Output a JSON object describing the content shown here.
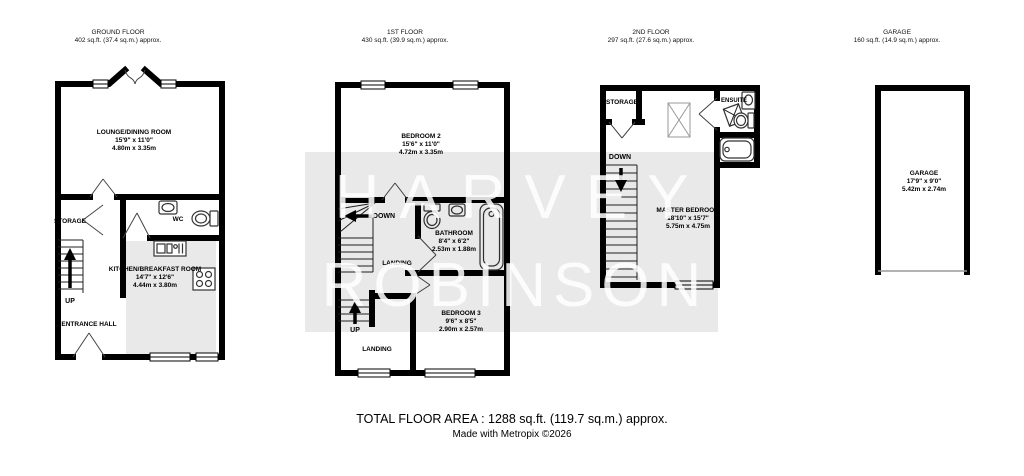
{
  "watermark": {
    "line1": "HARVEY",
    "line2": "ROBINSON"
  },
  "footer": {
    "total_area": "TOTAL FLOOR AREA : 1288 sq.ft. (119.7 sq.m.) approx.",
    "credit": "Made with Metropix ©2026"
  },
  "floors": {
    "ground": {
      "title": "GROUND FLOOR",
      "area": "402 sq.ft. (37.4 sq.m.) approx.",
      "rooms": {
        "lounge": {
          "name": "LOUNGE/DINING ROOM",
          "imperial": "15'9\" x 11'0\"",
          "metric": "4.80m x 3.35m"
        },
        "kitchen": {
          "name": "KITCHEN/BREAKFAST ROOM",
          "imperial": "14'7\" x 12'6\"",
          "metric": "4.44m x 3.80m"
        },
        "storage": "STORAGE",
        "wc": "WC",
        "entrance_hall": "ENTRANCE HALL",
        "up": "UP"
      }
    },
    "first": {
      "title": "1ST FLOOR",
      "area": "430 sq.ft. (39.9 sq.m.) approx.",
      "rooms": {
        "bedroom2": {
          "name": "BEDROOM 2",
          "imperial": "15'6\" x 11'0\"",
          "metric": "4.72m x 3.35m"
        },
        "bathroom": {
          "name": "BATHROOM",
          "imperial": "8'4\" x 6'2\"",
          "metric": "2.53m x 1.88m"
        },
        "bedroom3": {
          "name": "BEDROOM 3",
          "imperial": "9'6\" x 8'5\"",
          "metric": "2.90m x 2.57m"
        },
        "landing_upper": "LANDING",
        "landing_lower": "LANDING",
        "down": "DOWN",
        "up": "UP"
      }
    },
    "second": {
      "title": "2ND FLOOR",
      "area": "297 sq.ft. (27.6 sq.m.) approx.",
      "rooms": {
        "master": {
          "name": "MASTER BEDROOM",
          "imperial": "18'10\" x 15'7\"",
          "metric": "5.75m x 4.75m"
        },
        "storage": "STORAGE",
        "ensuite": "ENSUITE",
        "down": "DOWN"
      }
    },
    "garage": {
      "title": "GARAGE",
      "area": "160 sq.ft. (14.9 sq.m.) approx.",
      "rooms": {
        "garage": {
          "name": "GARAGE",
          "imperial": "17'9\" x 9'0\"",
          "metric": "5.42m x 2.74m"
        }
      }
    }
  }
}
